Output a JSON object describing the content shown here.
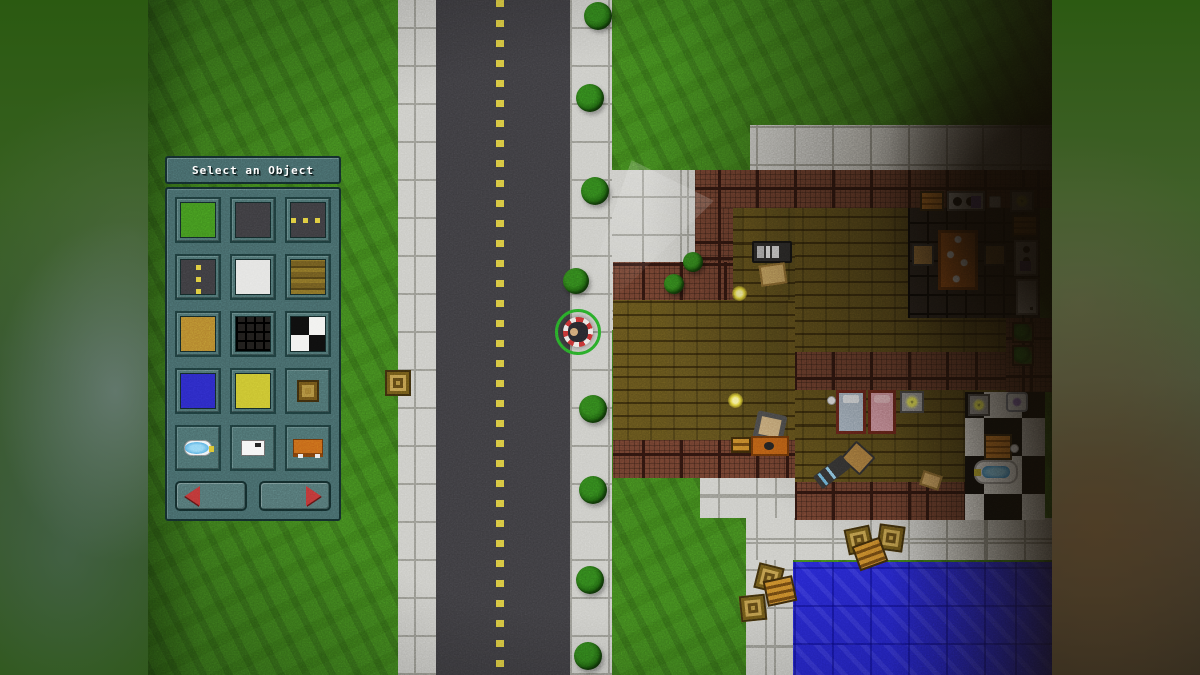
{
  "hud": {
    "title": "Select an Object",
    "tiles": [
      {
        "id": "grass"
      },
      {
        "id": "asphalt"
      },
      {
        "id": "road-h"
      },
      {
        "id": "road-v"
      },
      {
        "id": "concrete"
      },
      {
        "id": "wood"
      },
      {
        "id": "sand"
      },
      {
        "id": "darkgrid"
      },
      {
        "id": "checker"
      },
      {
        "id": "water"
      },
      {
        "id": "hay"
      },
      {
        "id": "crate"
      },
      {
        "id": "bathtub"
      },
      {
        "id": "paper"
      },
      {
        "id": "bench"
      }
    ],
    "nav": {
      "prev": "previous-objects-page",
      "next": "next-objects-page"
    }
  },
  "colors": {
    "grass": "#3d7d1c",
    "road": "#3b3a3e",
    "road_dash": "#d4c23e",
    "sidewalk": "#c9c9c4",
    "wood_floor": "#6b5a20",
    "wall_brick": "#693c2c",
    "water": "#2525c8",
    "panel": "#416263",
    "panel_border": "#122a2a",
    "arrow_red": "#b83434",
    "selection_ring": "#28a828"
  },
  "map": {
    "regions": [
      [
        "grass",
        0,
        0,
        904,
        675
      ],
      [
        "sidewalk",
        250,
        0,
        38,
        675
      ],
      [
        "road",
        288,
        0,
        134,
        675
      ],
      [
        "dash",
        348,
        0,
        8,
        675
      ],
      [
        "sidewalk",
        422,
        0,
        42,
        675
      ],
      [
        "sidewalk",
        464,
        170,
        83,
        160
      ],
      [
        "sidewalk",
        602,
        125,
        302,
        45
      ],
      [
        "sidewalk",
        602,
        170,
        45,
        390
      ],
      [
        "sidewalk",
        552,
        478,
        95,
        40
      ],
      [
        "sidewalk",
        598,
        518,
        306,
        42
      ],
      [
        "sidewalk",
        598,
        560,
        47,
        115
      ],
      [
        "water",
        645,
        562,
        259,
        113
      ],
      [
        "wood",
        585,
        208,
        62,
        92
      ],
      [
        "wood",
        465,
        300,
        182,
        140
      ],
      [
        "wood",
        647,
        208,
        219,
        274
      ],
      [
        "kfloor",
        760,
        208,
        132,
        110
      ],
      [
        "checker",
        817,
        392,
        80,
        128
      ],
      [
        "wall",
        547,
        170,
        357,
        38
      ],
      [
        "wall",
        547,
        208,
        38,
        92
      ],
      [
        "wall",
        465,
        262,
        120,
        38
      ],
      [
        "wall",
        465,
        440,
        182,
        38
      ],
      [
        "wall",
        647,
        352,
        219,
        38
      ],
      [
        "wall",
        858,
        318,
        46,
        74
      ],
      [
        "wall",
        647,
        482,
        170,
        38
      ]
    ],
    "objects": [
      [
        "crate",
        237,
        370,
        26,
        26,
        0
      ],
      [
        "tv",
        604,
        241,
        40,
        22,
        0
      ],
      [
        "box",
        612,
        264,
        26,
        21,
        -8
      ],
      [
        "coin",
        584,
        286,
        15,
        15,
        0
      ],
      [
        "counter",
        772,
        191,
        24,
        20,
        0
      ],
      [
        "stove",
        799,
        191,
        38,
        20,
        0
      ],
      [
        "whiteblock",
        841,
        196,
        12,
        12,
        0
      ],
      [
        "lamp",
        862,
        190,
        24,
        22,
        0
      ],
      [
        "counter",
        864,
        215,
        26,
        22,
        0
      ],
      [
        "appliance",
        866,
        240,
        24,
        36,
        0
      ],
      [
        "fridge",
        868,
        279,
        22,
        36,
        0
      ],
      [
        "table",
        790,
        230,
        40,
        60,
        0
      ],
      [
        "chair",
        764,
        244,
        22,
        22,
        0
      ],
      [
        "chair",
        836,
        244,
        22,
        22,
        0
      ],
      [
        "wallplant",
        864,
        322,
        22,
        21,
        0
      ],
      [
        "wallplant",
        864,
        345,
        22,
        21,
        0
      ],
      [
        "coin",
        580,
        393,
        15,
        15,
        0
      ],
      [
        "armchair",
        607,
        413,
        30,
        28,
        12
      ],
      [
        "pallet",
        583,
        437,
        20,
        16,
        0
      ],
      [
        "sofa",
        603,
        436,
        38,
        20,
        0
      ],
      [
        "bedblue",
        688,
        390,
        30,
        44,
        0
      ],
      [
        "bedpink",
        720,
        390,
        28,
        44,
        0
      ],
      [
        "lamp",
        752,
        391,
        24,
        22,
        0
      ],
      [
        "ball",
        679,
        396,
        9,
        9,
        0
      ],
      [
        "chair",
        697,
        446,
        26,
        24,
        42
      ],
      [
        "gun",
        666,
        464,
        36,
        16,
        -38
      ],
      [
        "box",
        773,
        473,
        20,
        15,
        18
      ],
      [
        "lamp",
        820,
        394,
        22,
        22,
        0
      ],
      [
        "sink",
        858,
        392,
        22,
        20,
        0
      ],
      [
        "counter",
        836,
        434,
        28,
        26,
        0
      ],
      [
        "bathtub",
        826,
        460,
        44,
        24,
        0
      ],
      [
        "ball",
        862,
        444,
        9,
        9,
        0
      ],
      [
        "crate",
        698,
        527,
        26,
        26,
        -12
      ],
      [
        "crate",
        730,
        525,
        26,
        26,
        8
      ],
      [
        "pallet",
        707,
        541,
        30,
        26,
        -20
      ],
      [
        "crate",
        608,
        565,
        26,
        26,
        14
      ],
      [
        "pallet",
        617,
        578,
        30,
        26,
        -12
      ],
      [
        "crate",
        592,
        595,
        26,
        26,
        -6
      ]
    ],
    "bushes": [
      [
        436,
        2,
        28
      ],
      [
        428,
        84,
        28
      ],
      [
        433,
        177,
        28
      ],
      [
        415,
        268,
        26
      ],
      [
        535,
        252,
        20
      ],
      [
        516,
        274,
        20
      ],
      [
        431,
        395,
        28
      ],
      [
        431,
        476,
        28
      ],
      [
        428,
        566,
        28
      ],
      [
        426,
        642,
        28
      ]
    ],
    "beam": {
      "x": 416,
      "y": 160,
      "w": 150,
      "h": 185
    },
    "character": {
      "x": 407,
      "y": 309,
      "size": 46
    }
  }
}
